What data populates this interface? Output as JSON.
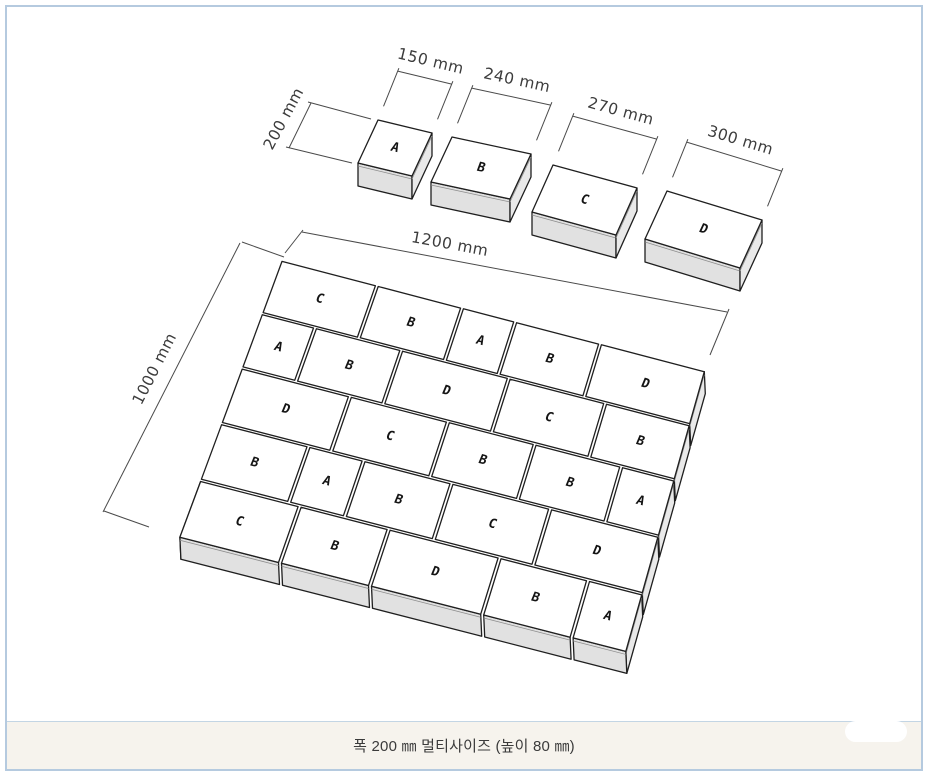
{
  "page": {
    "footer_caption": "폭 200 ㎜ 멀티사이즈 (높이 80 ㎜)",
    "border_color": "#b5cadf",
    "footer_background": "#f6f3ed"
  },
  "diagram": {
    "unit": "mm",
    "block_depth_mm": 200,
    "block_height_mm": 80,
    "depth_label": "200 mm",
    "samples": [
      {
        "label": "A",
        "width_mm": 150,
        "width_label": "150 mm"
      },
      {
        "label": "B",
        "width_mm": 240,
        "width_label": "240 mm"
      },
      {
        "label": "C",
        "width_mm": 270,
        "width_label": "270 mm"
      },
      {
        "label": "D",
        "width_mm": 300,
        "width_label": "300 mm"
      }
    ],
    "block_widths_mm": {
      "A": 150,
      "B": 240,
      "C": 270,
      "D": 300
    },
    "panel": {
      "width_mm": 1200,
      "depth_mm": 1000,
      "width_label": "1200 mm",
      "depth_label": "1000 mm",
      "rows": [
        [
          "C",
          "B",
          "A",
          "B",
          "D"
        ],
        [
          "A",
          "B",
          "D",
          "C",
          "B"
        ],
        [
          "D",
          "C",
          "B",
          "B",
          "A"
        ],
        [
          "B",
          "A",
          "B",
          "C",
          "D"
        ],
        [
          "C",
          "B",
          "D",
          "B",
          "A"
        ]
      ]
    },
    "colors": {
      "top_face": "#ffffff",
      "front_face": "#e1e1e1",
      "right_face": "#e9e9e9",
      "left_face": "#d6d6d6",
      "edge": "#1f1f1f",
      "dim_line": "#4a4a4a",
      "dim_text": "#3c3c3c",
      "letter": "#141414"
    }
  }
}
